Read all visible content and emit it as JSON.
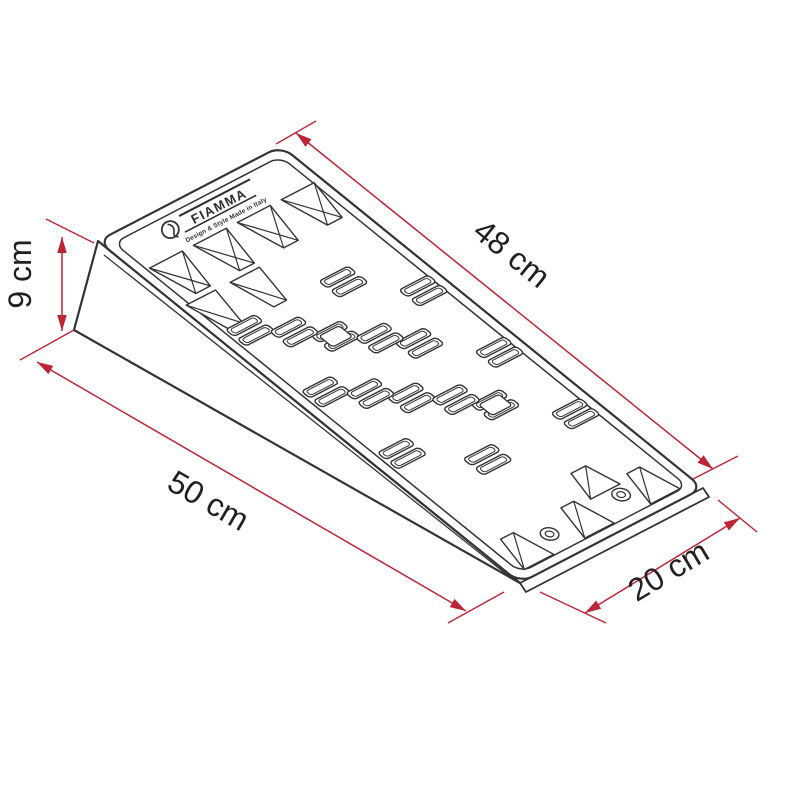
{
  "drawing": {
    "title": "leveling-ramp-technical-drawing",
    "logo": {
      "brand": "FIAMMA",
      "tagline": "Design & Style Made in Italy"
    },
    "dimensions": {
      "top_edge": "48 cm",
      "height": "9 cm",
      "length": "50 cm",
      "width": "20 cm"
    },
    "colors": {
      "dimension_red": "#bc2437",
      "outline": "#333333",
      "label_text": "#231f20",
      "background": "#ffffff"
    }
  }
}
